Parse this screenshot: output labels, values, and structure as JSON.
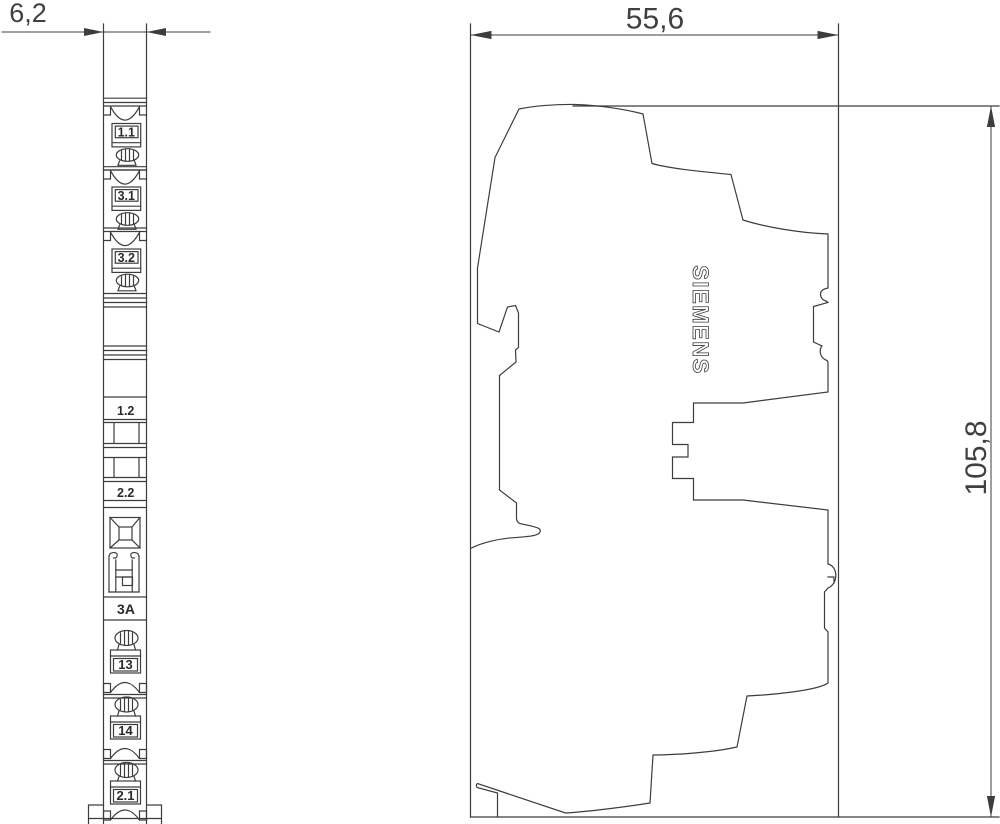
{
  "dimensions": {
    "front_width_mm": "6,2",
    "side_width_mm": "55,6",
    "side_height_mm": "105,8"
  },
  "front_view": {
    "terminal_labels_top": [
      "1.1",
      "3.1",
      "3.2"
    ],
    "mid_labels": [
      "1.2",
      "2.2"
    ],
    "fuse_rating": "3A",
    "terminal_labels_bottom": [
      "13",
      "14",
      "2.1"
    ]
  },
  "side_view": {
    "brand": "SIEMENS"
  },
  "colors": {
    "line": "#3d3d3d",
    "text": "#404040",
    "background": "#ffffff"
  }
}
